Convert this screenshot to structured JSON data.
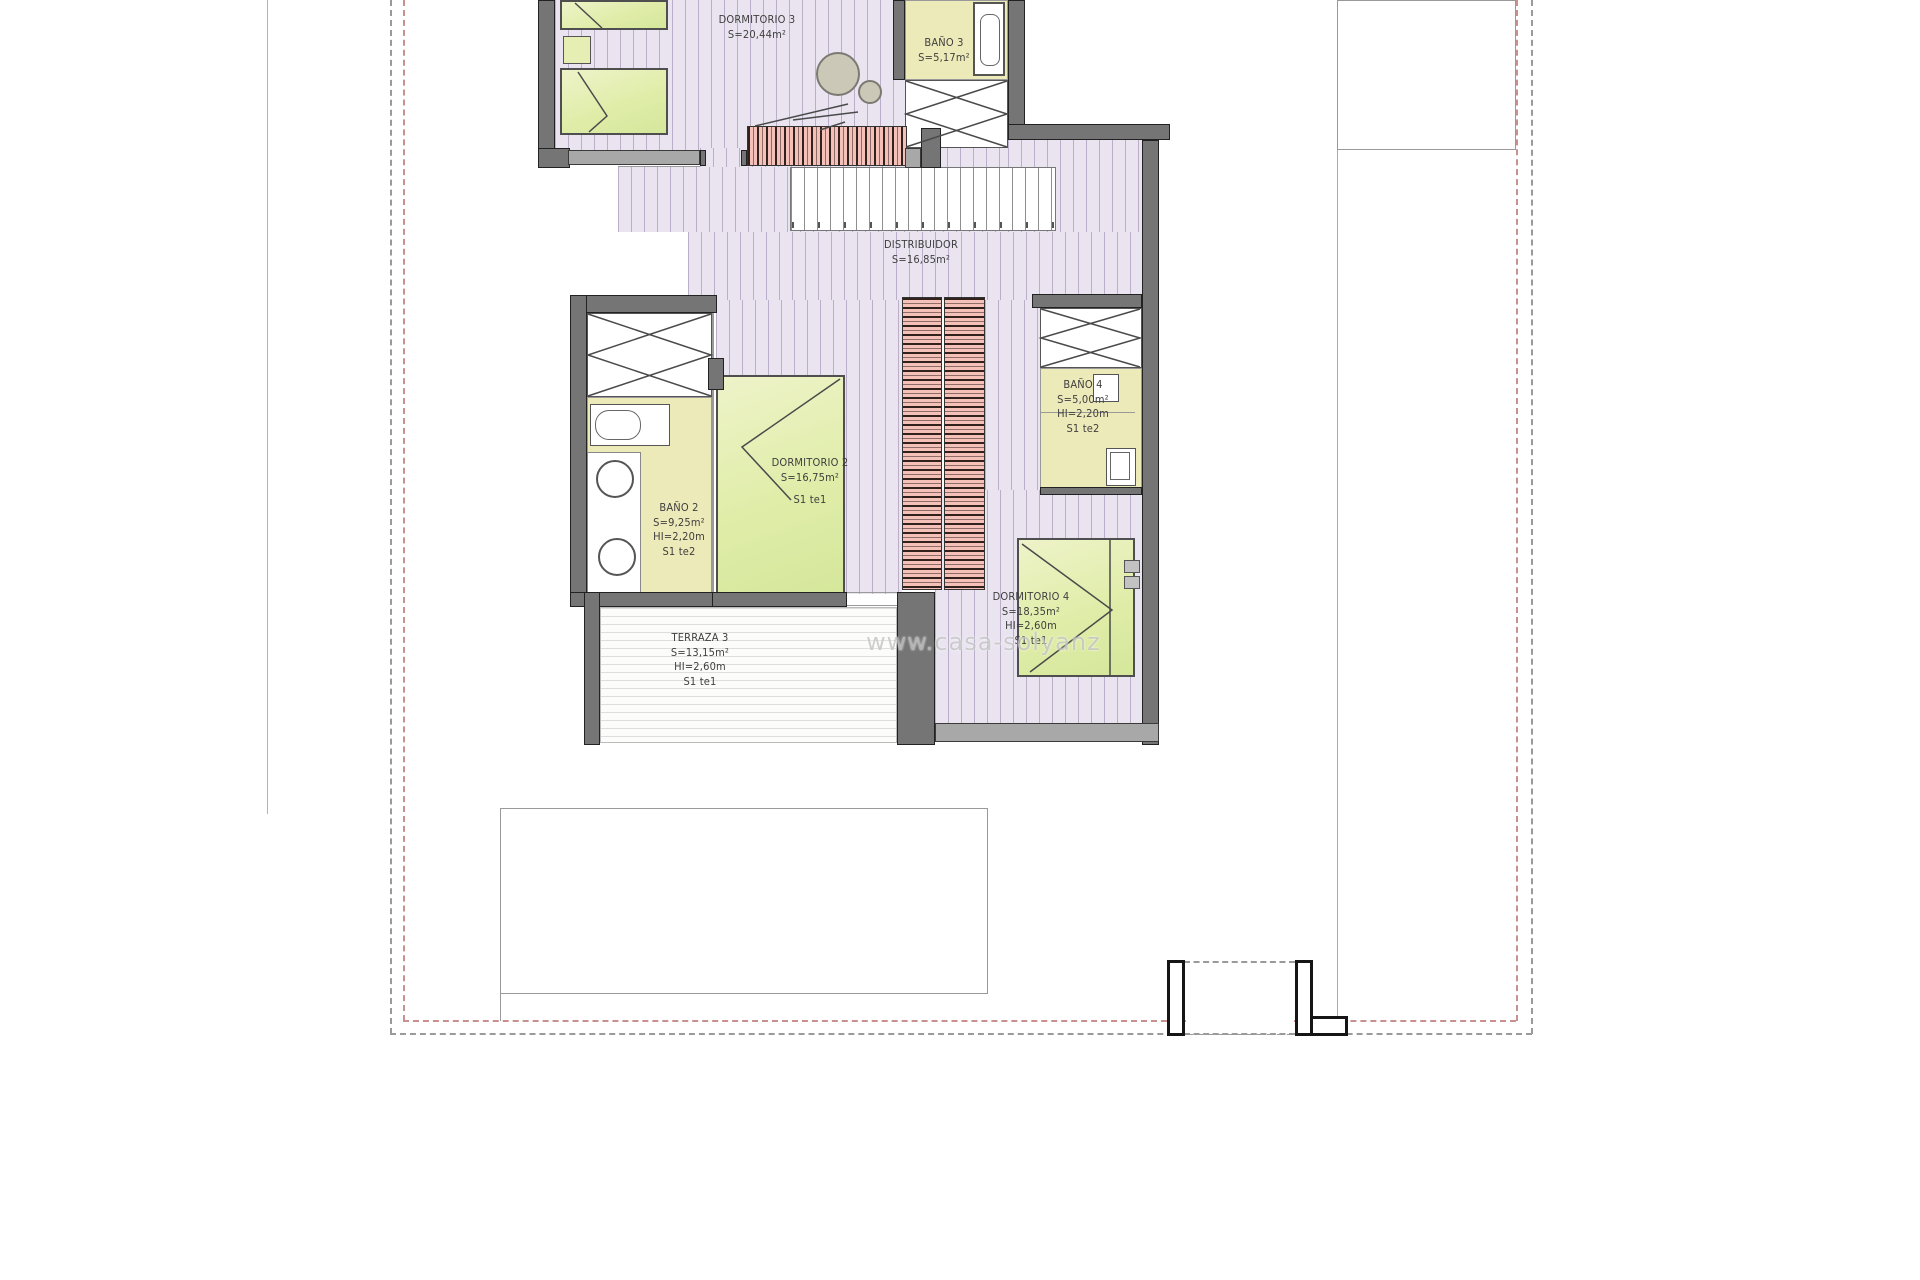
{
  "watermark": {
    "text": "www.casa-solyanz"
  },
  "plan": {
    "type": "architectural-floor-plan",
    "rooms": [
      {
        "id": "dormitorio-3",
        "label": "DORMITORIO 3",
        "area": "S=20,44m²"
      },
      {
        "id": "bano-3",
        "label": "BAÑO 3",
        "area": "S=5,17m²"
      },
      {
        "id": "distribuidor",
        "label": "DISTRIBUIDOR",
        "area": "S=16,85m²"
      },
      {
        "id": "dormitorio-2",
        "label": "DORMITORIO 2",
        "area": "S=16,75m²",
        "note": "S1 te1"
      },
      {
        "id": "bano-2",
        "label": "BAÑO 2",
        "area": "S=9,25m²",
        "height": "HI=2,20m",
        "note": "S1 te2"
      },
      {
        "id": "bano-4",
        "label": "BAÑO 4",
        "area": "S=5,00m²",
        "height": "HI=2,20m",
        "note": "S1 te2"
      },
      {
        "id": "dormitorio-4",
        "label": "DORMITORIO 4",
        "area": "S=18,35m²",
        "height": "HI=2,60m",
        "note": "S1 te1"
      },
      {
        "id": "terraza-3",
        "label": "TERRAZA 3",
        "area": "S=13,15m²",
        "height": "HI=2,60m",
        "note": "S1 te1"
      }
    ],
    "colors": {
      "floor_wood": "#eae4f0",
      "floor_tile": "#edeab9",
      "bed": "#e2eda6",
      "wardrobe": "#f4c0b8",
      "wall": "#757575",
      "boundary_dashed": "#c99090"
    }
  }
}
